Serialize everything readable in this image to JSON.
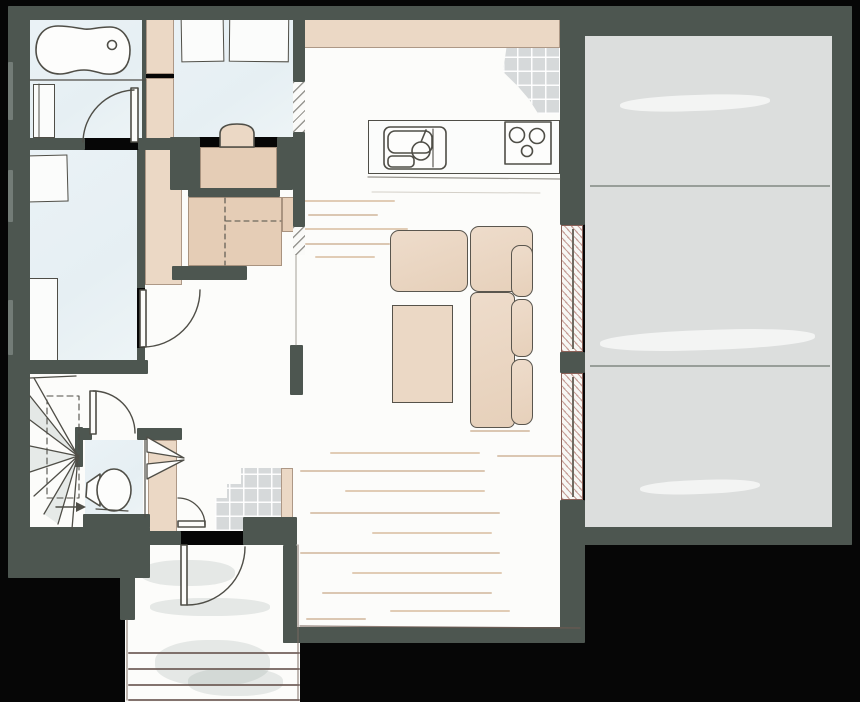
{
  "type": "architectural-floor-plan",
  "colors": {
    "background": "#060606",
    "wall": "#4d5650",
    "floor_blue": "#e8f0f4",
    "floor_white": "#fcfcfa",
    "floor_garage": "#dcdedd",
    "tile_gray": "#d6d9da",
    "furniture_tan": "#ebd8c5",
    "desk_tan": "#e5cdb6",
    "sketch_outline": "#4f4e47",
    "window_hatch_red": "#984a3f",
    "wood_streak": "#dcc3a8"
  },
  "rooms": [
    {
      "name": "bathroom",
      "floor": "light-blue",
      "fixtures": [
        "bathtub",
        "vanity",
        "door"
      ]
    },
    {
      "name": "office",
      "floor": "light-blue",
      "fixtures": [
        "wall-shelf",
        "wall-shelf",
        "desk",
        "chair",
        "closet-strip"
      ]
    },
    {
      "name": "bedroom",
      "floor": "light-blue",
      "fixtures": [
        "side-table",
        "wardrobe",
        "closet-strip",
        "door"
      ]
    },
    {
      "name": "hallway",
      "floor": "white",
      "fixtures": [
        "built-in-closet",
        "wall-openings"
      ]
    },
    {
      "name": "staircase",
      "floor": "white",
      "fixtures": [
        "winder-stairs",
        "walk-line",
        "direction-arrow"
      ]
    },
    {
      "name": "wc",
      "floor": "light-blue",
      "fixtures": [
        "toilet",
        "door"
      ]
    },
    {
      "name": "entry",
      "floor": "tile",
      "fixtures": [
        "coat-rack",
        "closet",
        "closet-door"
      ]
    },
    {
      "name": "porch",
      "floor": "white",
      "fixtures": [
        "entry-door",
        "outdoor-steps"
      ]
    },
    {
      "name": "kitchen",
      "floor": "white",
      "fixtures": [
        "counter",
        "sink",
        "stove",
        "upper-cabinet-band",
        "tiled-splash"
      ]
    },
    {
      "name": "living-room",
      "floor": "wood-streaked-white",
      "fixtures": [
        "l-sofa",
        "coffee-table"
      ]
    },
    {
      "name": "garage",
      "floor": "concrete-gray",
      "fixtures": [
        "floor-joint-lines"
      ]
    }
  ],
  "windows": [
    {
      "wall": "living-garage",
      "x": 561,
      "y": 225,
      "w": 22,
      "h": 127
    },
    {
      "wall": "living-garage",
      "x": 561,
      "y": 373,
      "w": 22,
      "h": 127
    }
  ],
  "doors": [
    "bathroom",
    "bedroom",
    "wc",
    "entry-closet",
    "front-entry"
  ],
  "wood_streaks": [
    {
      "x": 300,
      "y": 200,
      "w": 95
    },
    {
      "x": 308,
      "y": 214,
      "w": 70,
      "v": 2
    },
    {
      "x": 298,
      "y": 228,
      "w": 110
    },
    {
      "x": 305,
      "y": 243,
      "w": 85,
      "v": 2
    },
    {
      "x": 315,
      "y": 256,
      "w": 60
    },
    {
      "x": 470,
      "y": 430,
      "w": 60,
      "v": 2
    },
    {
      "x": 497,
      "y": 455,
      "w": 70,
      "v": 2
    },
    {
      "x": 330,
      "y": 452,
      "w": 150
    },
    {
      "x": 300,
      "y": 470,
      "w": 185,
      "v": 2
    },
    {
      "x": 345,
      "y": 490,
      "w": 140
    },
    {
      "x": 310,
      "y": 512,
      "w": 190,
      "v": 2
    },
    {
      "x": 372,
      "y": 532,
      "w": 120
    },
    {
      "x": 300,
      "y": 552,
      "w": 200,
      "v": 2
    },
    {
      "x": 352,
      "y": 572,
      "w": 150
    },
    {
      "x": 322,
      "y": 592,
      "w": 170,
      "v": 2
    },
    {
      "x": 390,
      "y": 610,
      "w": 120
    },
    {
      "x": 306,
      "y": 618,
      "w": 60,
      "v": 2
    }
  ],
  "porch_steps": [
    {
      "x": 128,
      "y": 652,
      "w": 172
    },
    {
      "x": 128,
      "y": 668,
      "w": 172
    },
    {
      "x": 128,
      "y": 684,
      "w": 172
    },
    {
      "x": 128,
      "y": 699,
      "w": 172
    }
  ],
  "garage_joints": [
    {
      "x": 590,
      "y": 185,
      "w": 240
    },
    {
      "x": 590,
      "y": 365,
      "w": 240
    }
  ],
  "garage_sheens": [
    {
      "x": 620,
      "y": 95,
      "w": 150,
      "h": 16
    },
    {
      "x": 600,
      "y": 330,
      "w": 215,
      "h": 20
    },
    {
      "x": 640,
      "y": 480,
      "w": 120,
      "h": 14
    }
  ],
  "porch_washes": [
    {
      "x": 140,
      "y": 560,
      "w": 95,
      "h": 26
    },
    {
      "x": 150,
      "y": 598,
      "w": 120,
      "h": 18
    },
    {
      "x": 155,
      "y": 640,
      "w": 115,
      "h": 46
    },
    {
      "x": 188,
      "y": 668,
      "w": 95,
      "h": 28
    }
  ]
}
